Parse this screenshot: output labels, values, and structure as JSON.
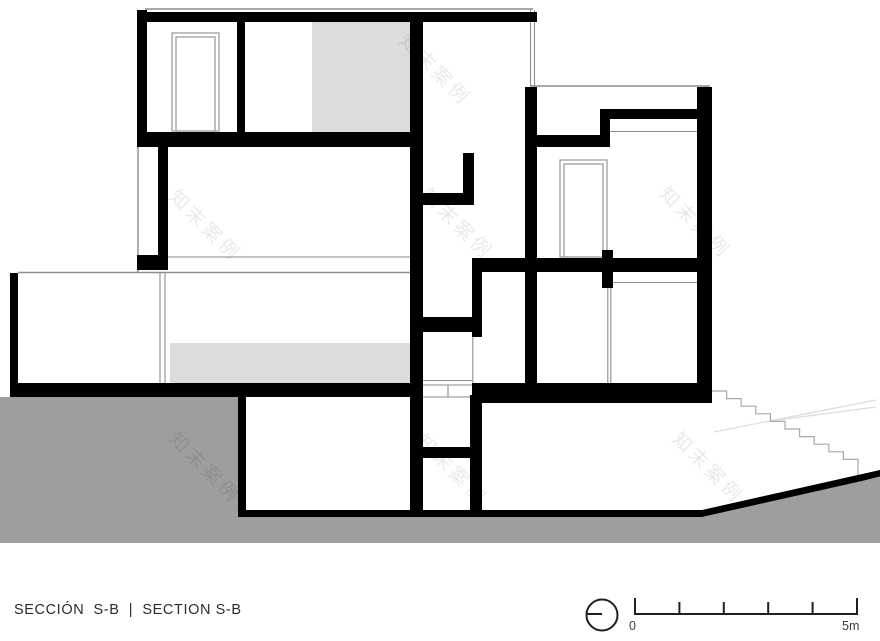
{
  "title": {
    "text": "SECCIÓN  S-B  |  SECTION S-B"
  },
  "scale_bar": {
    "start_label": "0",
    "end_label": "5m",
    "tick_count": 6,
    "intervals": 5,
    "unit": "m"
  },
  "watermark": {
    "text": "知末案例"
  },
  "colors": {
    "ink": "#000000",
    "thin_line": "#8c8c8c",
    "panel": "#dcdcdc",
    "ground": "#9e9e9e",
    "step_line": "#a8a8a8",
    "faint_line": "#dcdcdc",
    "text": "#2d2d2d",
    "background": "#ffffff"
  }
}
